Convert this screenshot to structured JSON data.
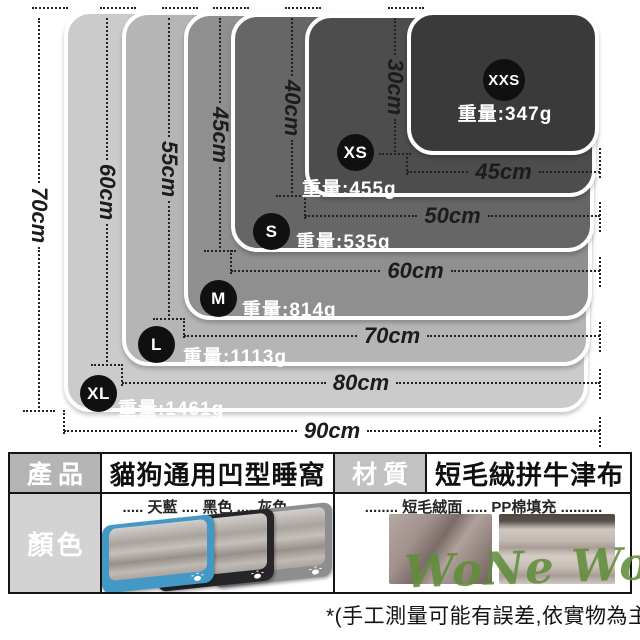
{
  "page": {
    "background": "#ffffff"
  },
  "diagram": {
    "line_color": "#222222",
    "badge_color": "#101010",
    "sizes": [
      {
        "code": "XL",
        "weight_label": "重量:1461g",
        "width_label": "90cm",
        "height_label": "70cm",
        "width_cm": 90,
        "height_cm": 70,
        "weight_g": 1461,
        "fill": "#cbcbcb"
      },
      {
        "code": "L",
        "weight_label": "重量:1113g",
        "width_label": "80cm",
        "height_label": "60cm",
        "width_cm": 80,
        "height_cm": 60,
        "weight_g": 1113,
        "fill": "#b5b5b5"
      },
      {
        "code": "M",
        "weight_label": "重量:814g",
        "width_label": "70cm",
        "height_label": "55cm",
        "width_cm": 70,
        "height_cm": 55,
        "weight_g": 814,
        "fill": "#8f8f8f"
      },
      {
        "code": "S",
        "weight_label": "重量:535g",
        "width_label": "60cm",
        "height_label": "45cm",
        "width_cm": 60,
        "height_cm": 45,
        "weight_g": 535,
        "fill": "#666666"
      },
      {
        "code": "XS",
        "weight_label": "重量:455g",
        "width_label": "50cm",
        "height_label": "40cm",
        "width_cm": 50,
        "height_cm": 40,
        "weight_g": 455,
        "fill": "#4d4d4d"
      },
      {
        "code": "XXS",
        "weight_label": "重量:347g",
        "width_label": "45cm",
        "height_label": "30cm",
        "width_cm": 45,
        "height_cm": 30,
        "weight_g": 347,
        "fill": "#3a3a3a"
      }
    ]
  },
  "spec_table": {
    "product_label": "產品",
    "product_value": "貓狗通用凹型睡窩",
    "material_label": "材質",
    "material_value": "短毛絨拼牛津布",
    "color_label": "顏色",
    "color_options": "..... 天藍 .... 黑色 .... 灰色 .....",
    "fabric_options": "........ 短毛絨面 ..... PP棉填充 .........."
  },
  "beds": [
    {
      "name": "天藍",
      "shell": "#4498c6"
    },
    {
      "name": "黑色",
      "shell": "#26262a"
    },
    {
      "name": "灰色",
      "shell": "#8e8e90"
    }
  ],
  "watermark": "WoNe WoNe",
  "footnote": "*(手工測量可能有誤差,依實物為主)"
}
